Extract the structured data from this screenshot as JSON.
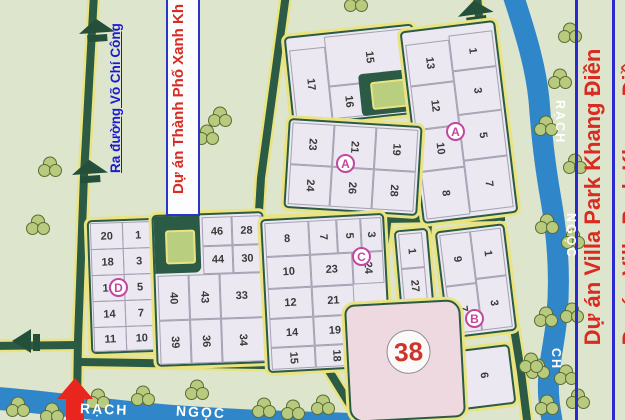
{
  "labels": {
    "exit_road": "Ra đường Võ Chí Công",
    "project_left": "Dự án Thành Phố Xanh Kh",
    "project_right": "Dự án Villa Park Khang Điền",
    "canal_right": {
      "r1": "RẠCH",
      "r2": "NGỌC",
      "r3": "CH"
    },
    "canal_bottom": {
      "r1": "RẠCH",
      "r2": "NGỌC"
    }
  },
  "markers": {
    "a1": "A",
    "a2": "A",
    "c": "C",
    "d": "D",
    "b": "B"
  },
  "blocks": {
    "top_a": {
      "lots": [
        "17",
        "15",
        "16"
      ]
    },
    "top_b": {
      "rows": [
        [
          "13",
          "1"
        ],
        [
          "12",
          "3"
        ],
        [
          "10",
          "5"
        ],
        [
          "8",
          "7"
        ]
      ]
    },
    "a2": {
      "rows": [
        [
          "23",
          "21",
          "19"
        ],
        [
          "24",
          "26",
          "28"
        ]
      ]
    },
    "d": {
      "rows": [
        [
          "20",
          "1"
        ],
        [
          "18",
          "3"
        ],
        [
          "16",
          "5"
        ],
        [
          "14",
          "7"
        ],
        [
          "11",
          "10"
        ]
      ]
    },
    "mid": {
      "top_rows": [
        [
          "46",
          "28"
        ],
        [
          "44",
          "30"
        ]
      ],
      "cols": [
        [
          "40",
          "39"
        ],
        [
          "43",
          "36"
        ],
        [
          "33",
          "34"
        ]
      ]
    },
    "c": {
      "rows": [
        [
          "8",
          "7",
          "5",
          "3"
        ],
        [
          "10",
          "23",
          "24"
        ],
        [
          "12",
          "21"
        ],
        [
          "14",
          "19"
        ],
        [
          "15",
          "18"
        ]
      ]
    },
    "narrow": {
      "lots": [
        "1",
        "27"
      ]
    },
    "b": {
      "rows": [
        [
          "9",
          "1"
        ],
        [
          "7",
          "3"
        ]
      ]
    },
    "lot6": "6",
    "big38": "38"
  },
  "colors": {
    "background": "#dde5cc",
    "road": "#2c5b45",
    "road_edge": "#e9e381",
    "block_fill": "#ebe8f2",
    "pink_block": "#eed9e1",
    "river": "#2f86c9",
    "tree": "#b7ca7d",
    "marker": "#c4479f",
    "number_38": "#cd352c",
    "label_blue": "#1a1ad6",
    "label_red": "#d92b21",
    "box_blue": "#2a35c8",
    "arrow_red": "#e8251f"
  }
}
